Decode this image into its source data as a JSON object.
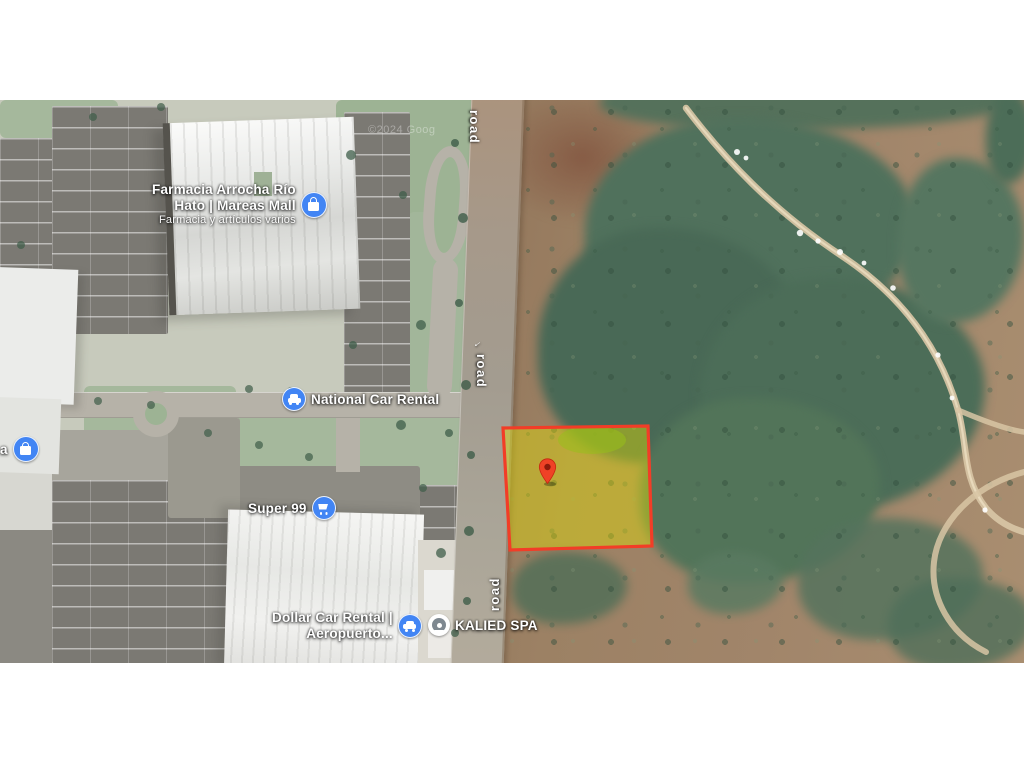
{
  "page": {
    "background": "#ffffff"
  },
  "map": {
    "type": "satellite-imagery",
    "watermark": "©2024 Goog",
    "one_way_arrow": "←",
    "poi_labels": {
      "farmacia": {
        "title_line1": "Farmacia Arrocha Río",
        "title_line2": "Hato | Mareas Mall",
        "subtitle": "Farmacia y artículos varios",
        "icon": "shopping-bag-icon"
      },
      "national_car_rental": {
        "title": "National Car Rental",
        "icon": "car-rental-icon"
      },
      "super_99": {
        "title": "Super 99",
        "icon": "shopping-cart-icon"
      },
      "dollar_car_rental": {
        "title_line1": "Dollar Car Rental |",
        "title_line2": "Aeropuerto...",
        "icon": "car-rental-icon"
      },
      "kalied_spa": {
        "title": "KALIED SPA",
        "icon": "generic-place-icon"
      },
      "edge_partial": {
        "title": "a",
        "icon": "shopping-bag-icon"
      }
    },
    "road_labels": {
      "top": "road",
      "middle": "road",
      "bottom": "road"
    },
    "marker": {
      "color": "#ef4226",
      "inner_color": "#8e1a0b"
    },
    "parcel": {
      "stroke": "#f23d27",
      "fill": "rgba(230,226,0,0.42)"
    },
    "colors": {
      "poi_icon_blue": "#4285f4",
      "label_text": "#ffffff",
      "terrain_brown": "#9c8164",
      "vegetation_green": "#4e6f5a",
      "developed_base": "#c7cabc",
      "lawn_green": "#a5b89c",
      "parking_gray": "#7b7973",
      "road_gray": "#b6b2a8",
      "building_white": "#eff0ee",
      "dirt_path_sand": "#d8c6a5"
    }
  }
}
